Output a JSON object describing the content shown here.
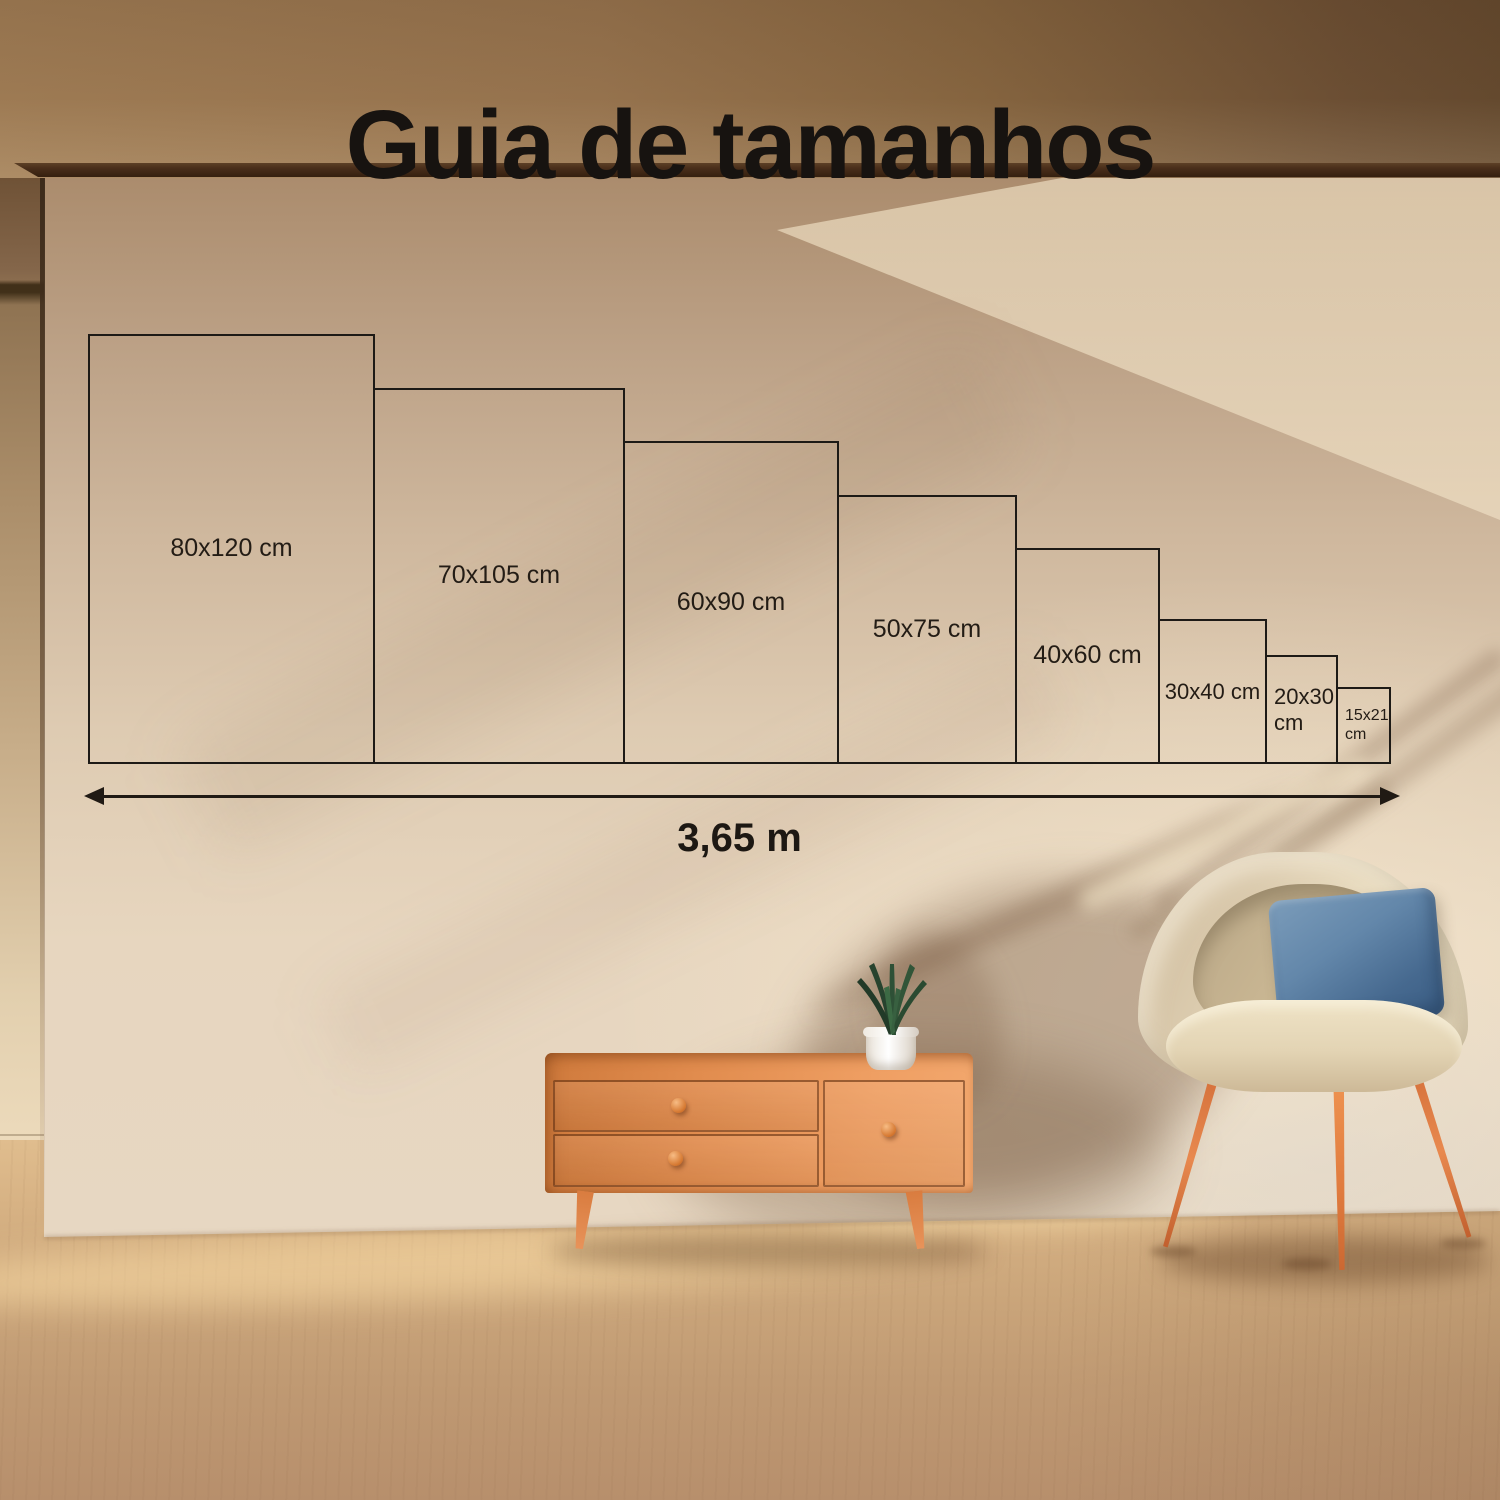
{
  "title": "Guia de tamanhos",
  "size_guide": {
    "sizes": [
      {
        "id": "80x120",
        "label": "80x120 cm",
        "width_cm": 80,
        "height_cm": 120
      },
      {
        "id": "70x105",
        "label": "70x105 cm",
        "width_cm": 70,
        "height_cm": 105
      },
      {
        "id": "60x90",
        "label": "60x90 cm",
        "width_cm": 60,
        "height_cm": 90
      },
      {
        "id": "50x75",
        "label": "50x75 cm",
        "width_cm": 50,
        "height_cm": 75
      },
      {
        "id": "40x60",
        "label": "40x60 cm",
        "width_cm": 40,
        "height_cm": 60
      },
      {
        "id": "30x40",
        "label": "30x40 cm",
        "width_cm": 30,
        "height_cm": 40
      },
      {
        "id": "20x30",
        "label": "20x30 cm",
        "width_cm": 20,
        "height_cm": 30
      },
      {
        "id": "15x21",
        "label": "15x21 cm",
        "width_cm": 15,
        "height_cm": 21
      }
    ],
    "total_width": {
      "label": "3,65 m",
      "meters": 3.65
    },
    "line_color": "#1d1a16",
    "text_color": "#231c15"
  },
  "scene": {
    "wall_color_top": "#ab8c6d",
    "wall_color_bottom": "#e7d7c2",
    "top_band_color": "#8f6d4a",
    "beam_color": "#4a2f1b",
    "floor_color": "#cfa87d",
    "cabinet_wood_color": "#ea9a60",
    "chair_fabric_color": "#e9dcc0",
    "pillow_color": "#5d80a2",
    "leg_wood_color": "#e0813f",
    "plant_color": "#2e5036",
    "pot_color": "#ffffff"
  }
}
